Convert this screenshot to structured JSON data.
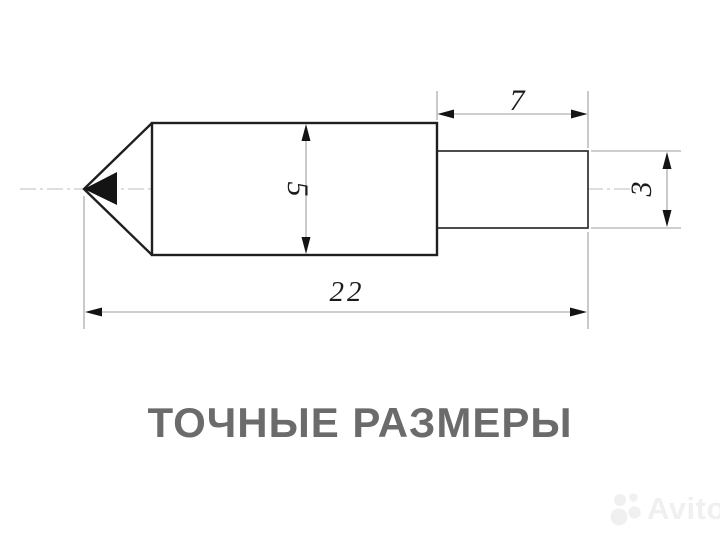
{
  "title": {
    "text": "ТОЧНЫЕ РАЗМЕРЫ",
    "color": "#6b6b6b"
  },
  "drawing": {
    "type": "technical-dimension-drawing",
    "part": "pointed pin with stepped shaft, side view",
    "dimensions": {
      "body_diameter": "5",
      "shaft_length": "7",
      "shaft_diameter": "3",
      "total_length": "22"
    },
    "colors": {
      "outline": "#1f1f1f",
      "thin_lines": "#9e9e9e",
      "centerline": "#bdbdbd",
      "dimension_text": "#1b1b1b",
      "background": "#ffffff"
    }
  },
  "watermark": {
    "text": "Avito",
    "color": "#f0f0f0"
  }
}
